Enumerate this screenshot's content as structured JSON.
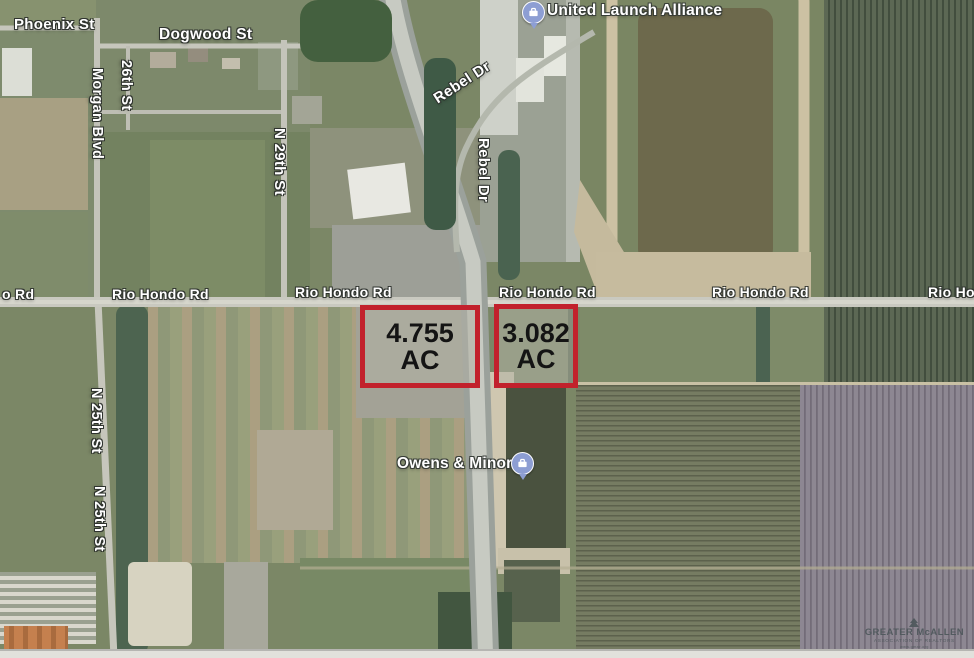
{
  "streets": {
    "phoenix": "Phoenix St",
    "dogwood": "Dogwood St",
    "morgan": "Morgan Blvd",
    "s26th": "26th St",
    "n29th": "N 29th St",
    "n25th_a": "N 25th St",
    "n25th_b": "N 25th St",
    "rebel_a": "Rebel Dr",
    "rebel_b": "Rebel Dr",
    "rio_left_partial": "o Rd",
    "rio_1": "Rio Hondo Rd",
    "rio_2": "Rio Hondo Rd",
    "rio_3": "Rio Hondo Rd",
    "rio_4": "Rio Hondo Rd",
    "rio_right_partial": "Rio Ho"
  },
  "pois": {
    "ula": "United Launch Alliance",
    "owens": "Owens & Minor"
  },
  "parcels": {
    "west": {
      "value": "4.755",
      "unit": "AC"
    },
    "east": {
      "value": "3.082",
      "unit": "AC"
    }
  },
  "watermark": {
    "org": "GREATER McALLEN",
    "assoc": "ASSOCIATION OF REALTORS",
    "url": "www.gmar.org"
  },
  "colors": {
    "parcel_border": "#c2212c",
    "poi_marker": "#8d9ed3",
    "label_text": "#ffffff",
    "road": "#c6c6bc",
    "highway": "#9ba19b"
  }
}
